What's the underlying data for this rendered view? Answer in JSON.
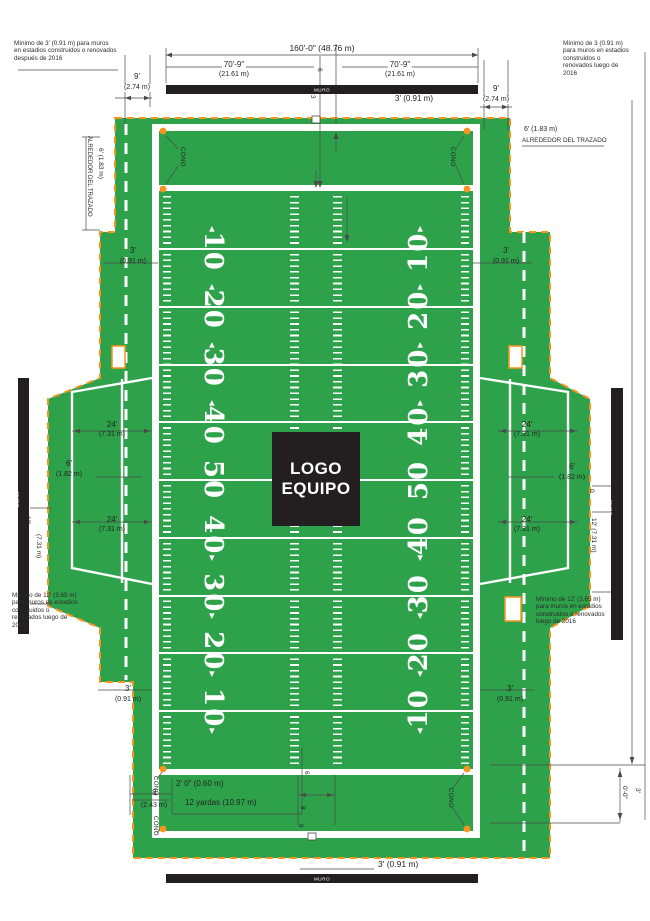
{
  "colors": {
    "green": "#2ea24b",
    "orange": "#f7941d",
    "wall": "#231f20"
  },
  "field": {
    "logo_line1": "LOGO",
    "logo_line2": "EQUIPO",
    "yard_numbers": [
      "10",
      "20",
      "30",
      "40",
      "50",
      "40",
      "30",
      "20",
      "10"
    ],
    "muro": "MURO",
    "cono": "CONO"
  },
  "labels": {
    "dim160": "160'-0\" (48.76 m)",
    "w709": "70'-9\"",
    "w709m": "(21.61 m)",
    "n9": "9'",
    "n9m": "(2.74 m)",
    "t3": "3'",
    "t3m": "(0.91 m)",
    "t3full": "3' (0.91 m)",
    "six183": "6' (1.83 m)",
    "around": "ALREDEDOR DEL TRAZADO",
    "t24": "24'",
    "t24m": "(7.31 m)",
    "t6": "6'",
    "t6m": "(1.82 m)",
    "t12": "12'",
    "t12m": "(7.31 m)",
    "t12full": "12' (7.31 m)",
    "zero": "0",
    "two0": "2' 0\" (0.60 m)",
    "yd12": "12 yardas (10.97 m)",
    "e8": "8'",
    "e8m": "(2.43 m)",
    "g6": "6",
    "g8": "8",
    "g9": "9",
    "c6": "6",
    "c3": "3",
    "c00": "0'-0\"",
    "c3f": "3'"
  },
  "notes": {
    "top_left": "Mínimo de 3' (0.91 m) para muros\nen estadios construidos o renovados\ndespués de 2016",
    "top_right": "Mínimo de 3 (0.91 m)\npara muros en estadios\nconstruidos o\nrenovados luego de\n2016",
    "bottom_left": "Mínimo de 12' (3.65 m)\npara muros en estadios\nconstruidos o\nrenovados luego de\n2016",
    "bottom_right": "Mínimo de 12' (3.65 m)\npara muros en estadios\nconstruidos o renovados\nluego de 2016"
  }
}
